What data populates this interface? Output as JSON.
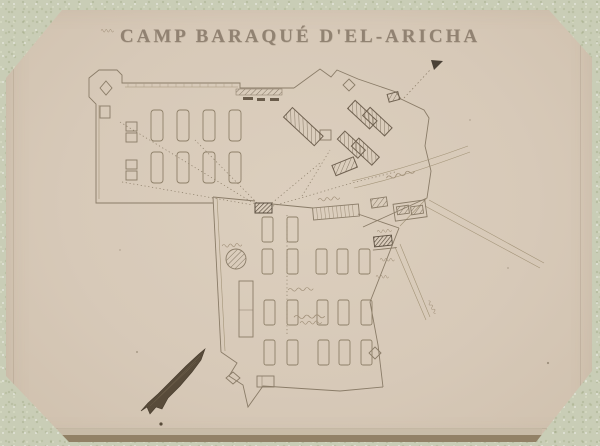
{
  "photo": {
    "title": "CAMP BARAQUÉ D'EL-ARICHA"
  },
  "plan": {
    "feature_names": [
      "left-fort-enclosure",
      "upper-redoubt-enclosure",
      "lower-camp-enclosure",
      "barrack-tent-rows",
      "hatched-buildings",
      "guard-post",
      "well-circle",
      "north-arrow",
      "direction-arrow",
      "handwritten-annotations-illegible"
    ]
  },
  "colors": {
    "mount_paper": "#c9cdb6",
    "photo_paper": "#d7c9b8",
    "ink": "#8a7c68",
    "ink_dark": "#55493b",
    "bottom_edge_strip": "#8d7c61",
    "title_ink": "#8c7d6d"
  }
}
